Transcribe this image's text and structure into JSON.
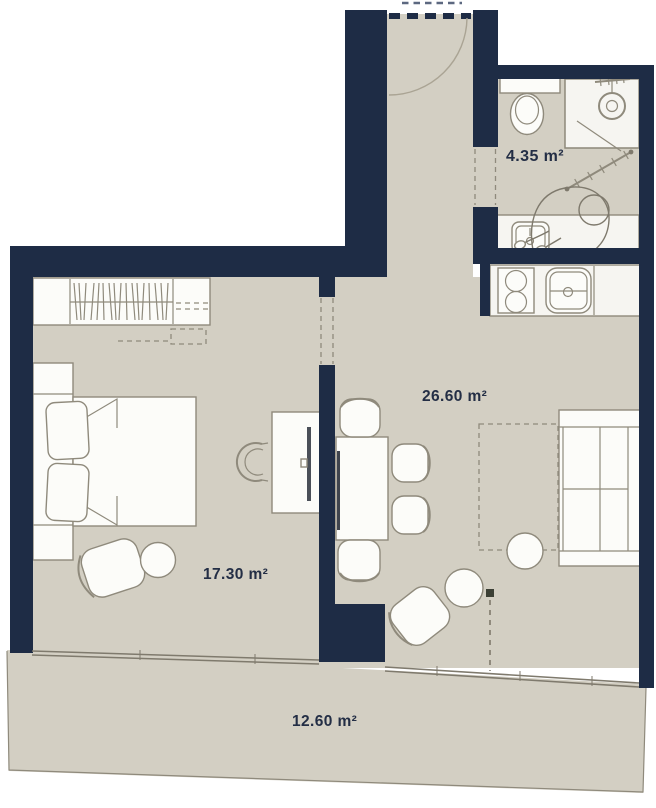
{
  "title": "apartment-floor-plan",
  "rooms": {
    "bathroom": {
      "name": "bathroom",
      "area": "4.35 m²"
    },
    "living_kitchen": {
      "name": "living-kitchen",
      "area": "26.60 m²"
    },
    "bedroom": {
      "name": "bedroom",
      "area": "17.30 m²"
    },
    "terrace": {
      "name": "terrace",
      "area": "12.60 m²"
    }
  },
  "fixtures": [
    "entry-door",
    "door-swing-arc",
    "bathroom-door",
    "wardrobe",
    "double-bed",
    "pillows",
    "nightstand",
    "desk",
    "monitor",
    "desk-chair",
    "bedroom-armchair",
    "round-stool",
    "dining-table",
    "wall-tv",
    "dining-chairs",
    "sofa-bed",
    "sofa-bed-extension",
    "coffee-table",
    "lounge-chair",
    "kitchen-counter",
    "stove",
    "kitchen-sink",
    "toilet",
    "shower",
    "shower-head",
    "shower-door",
    "towel-radiator",
    "washbasin",
    "person-at-washbasin",
    "terrace-glazing",
    "downpipe-marker"
  ],
  "colors": {
    "wall": "#1e2c45",
    "floor": "#d3cfc3",
    "floor_light": "#dbd8cd",
    "furniture": "#fcfcf9",
    "counter": "#f6f5f1",
    "stroke": "#8f8a7c",
    "label": "#232e45",
    "background": "#ffffff"
  }
}
